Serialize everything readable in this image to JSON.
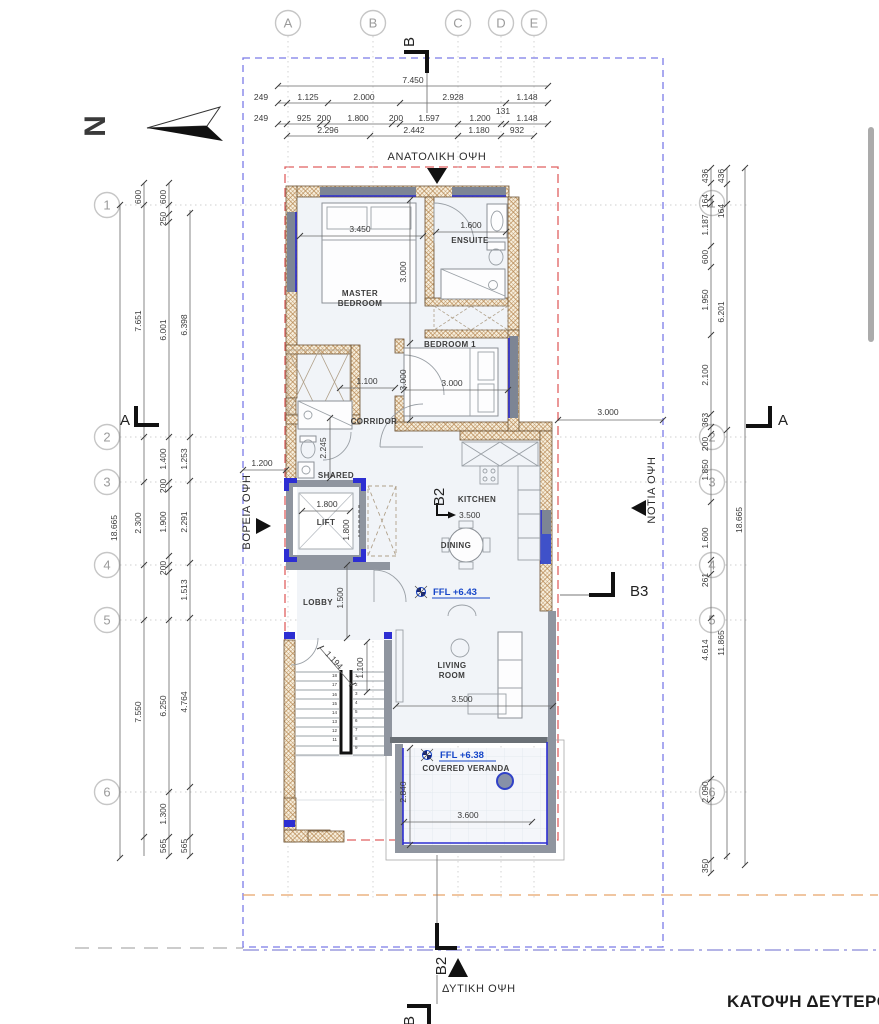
{
  "title": {
    "text": "ΚΑΤΟΨΗ ΔΕΥΤΕΡΟΥ Ο"
  },
  "north": {
    "label": "N"
  },
  "grid": {
    "cols": [
      "A",
      "B",
      "C",
      "D",
      "E"
    ],
    "rows": [
      "1",
      "2",
      "3",
      "4",
      "5",
      "6"
    ]
  },
  "sections": {
    "top": "B",
    "a_left": "A",
    "a_right": "A",
    "b2_plan": "B2",
    "b3": "B3",
    "b2_bottom": "B2",
    "b_bottom": "B"
  },
  "elevations": {
    "east": "ΑΝΑΤΟΛΙΚΗ ΟΨΗ",
    "north": "ΒΟΡΕΙΑ ΟΨΗ",
    "south": "ΝΟΤΙΑ ΟΨΗ",
    "west": "ΔΥΤΙΚΗ ΟΨΗ"
  },
  "rooms": {
    "master_line1": "MASTER",
    "master_line2": "BEDROOM",
    "ensuite": "ENSUITE",
    "bedroom1": "BEDROOM 1",
    "corridor": "CORRIDOR",
    "shared": "SHARED",
    "lift": "LIFT",
    "kitchen": "KITCHEN",
    "dining": "DINING",
    "lobby": "LOBBY",
    "living_line1": "LIVING",
    "living_line2": "ROOM",
    "veranda": "COVERED VERANDA"
  },
  "levels": {
    "ffl_living": "FFL +6.43",
    "ffl_veranda": "FFL +6.38"
  },
  "dims": {
    "overall_width": "7.450",
    "top_row2": [
      "249",
      "1.125",
      "2.000",
      "2.928",
      "1.148"
    ],
    "top_row3": [
      "249",
      "925",
      "200",
      "1.800",
      "200",
      "1.597",
      "1.200",
      "131",
      "1.148"
    ],
    "top_row4": [
      "2.296",
      "2.442",
      "1.180",
      "932"
    ],
    "left_col1": [
      "18.665"
    ],
    "left_col2": [
      "600",
      "7.651",
      "2.300",
      "7.550"
    ],
    "left_col3": [
      "600",
      "250",
      "6.001",
      "1.400",
      "200",
      "1.900",
      "200",
      "6.250",
      "1.300",
      "565"
    ],
    "left_col4": [
      "6.398",
      "1.253",
      "2.291",
      "1.513",
      "4.764",
      "565"
    ],
    "right_col1": [
      "436",
      "164",
      "1.187",
      "600",
      "1.950",
      "2.100",
      "363",
      "200",
      "1.850",
      "1.600",
      "261",
      "4.614",
      "2.090",
      "350"
    ],
    "right_col2": [
      "436",
      "164",
      "6.201",
      "11.865"
    ],
    "right_col3": [
      "18.665"
    ],
    "right_offset": "3.000",
    "plan": {
      "master_width": "3.450",
      "ensuite_width": "1.600",
      "master_depth": "3.000",
      "bedroom1_depth": "3.000",
      "bedroom1_width": "3.000",
      "corridor": "1.100",
      "shared_depth": "2.245",
      "shared_width": "1.200",
      "lift_width": "1.800",
      "lift_depth": "1.800",
      "kitchen": "3.500",
      "lobby": "1.500",
      "stair_diag": "1.194",
      "stair_width": "1.100",
      "living_width": "3.500",
      "veranda_depth": "2.840",
      "veranda_width": "3.600"
    }
  },
  "stairs": {
    "left": [
      "18",
      "17",
      "16",
      "15",
      "14",
      "13",
      "12",
      "11"
    ],
    "right": [
      "1",
      "2",
      "3",
      "4",
      "5",
      "6",
      "7",
      "8",
      "9"
    ]
  },
  "colors": {
    "accent_blue": "#2d2ed2",
    "ffl_blue": "#1646c8",
    "boundary_red": "#e06060",
    "boundary_blue": "#7b7be8",
    "boundary_orange": "#e8a569",
    "wall_hatch": "#b5854f"
  }
}
